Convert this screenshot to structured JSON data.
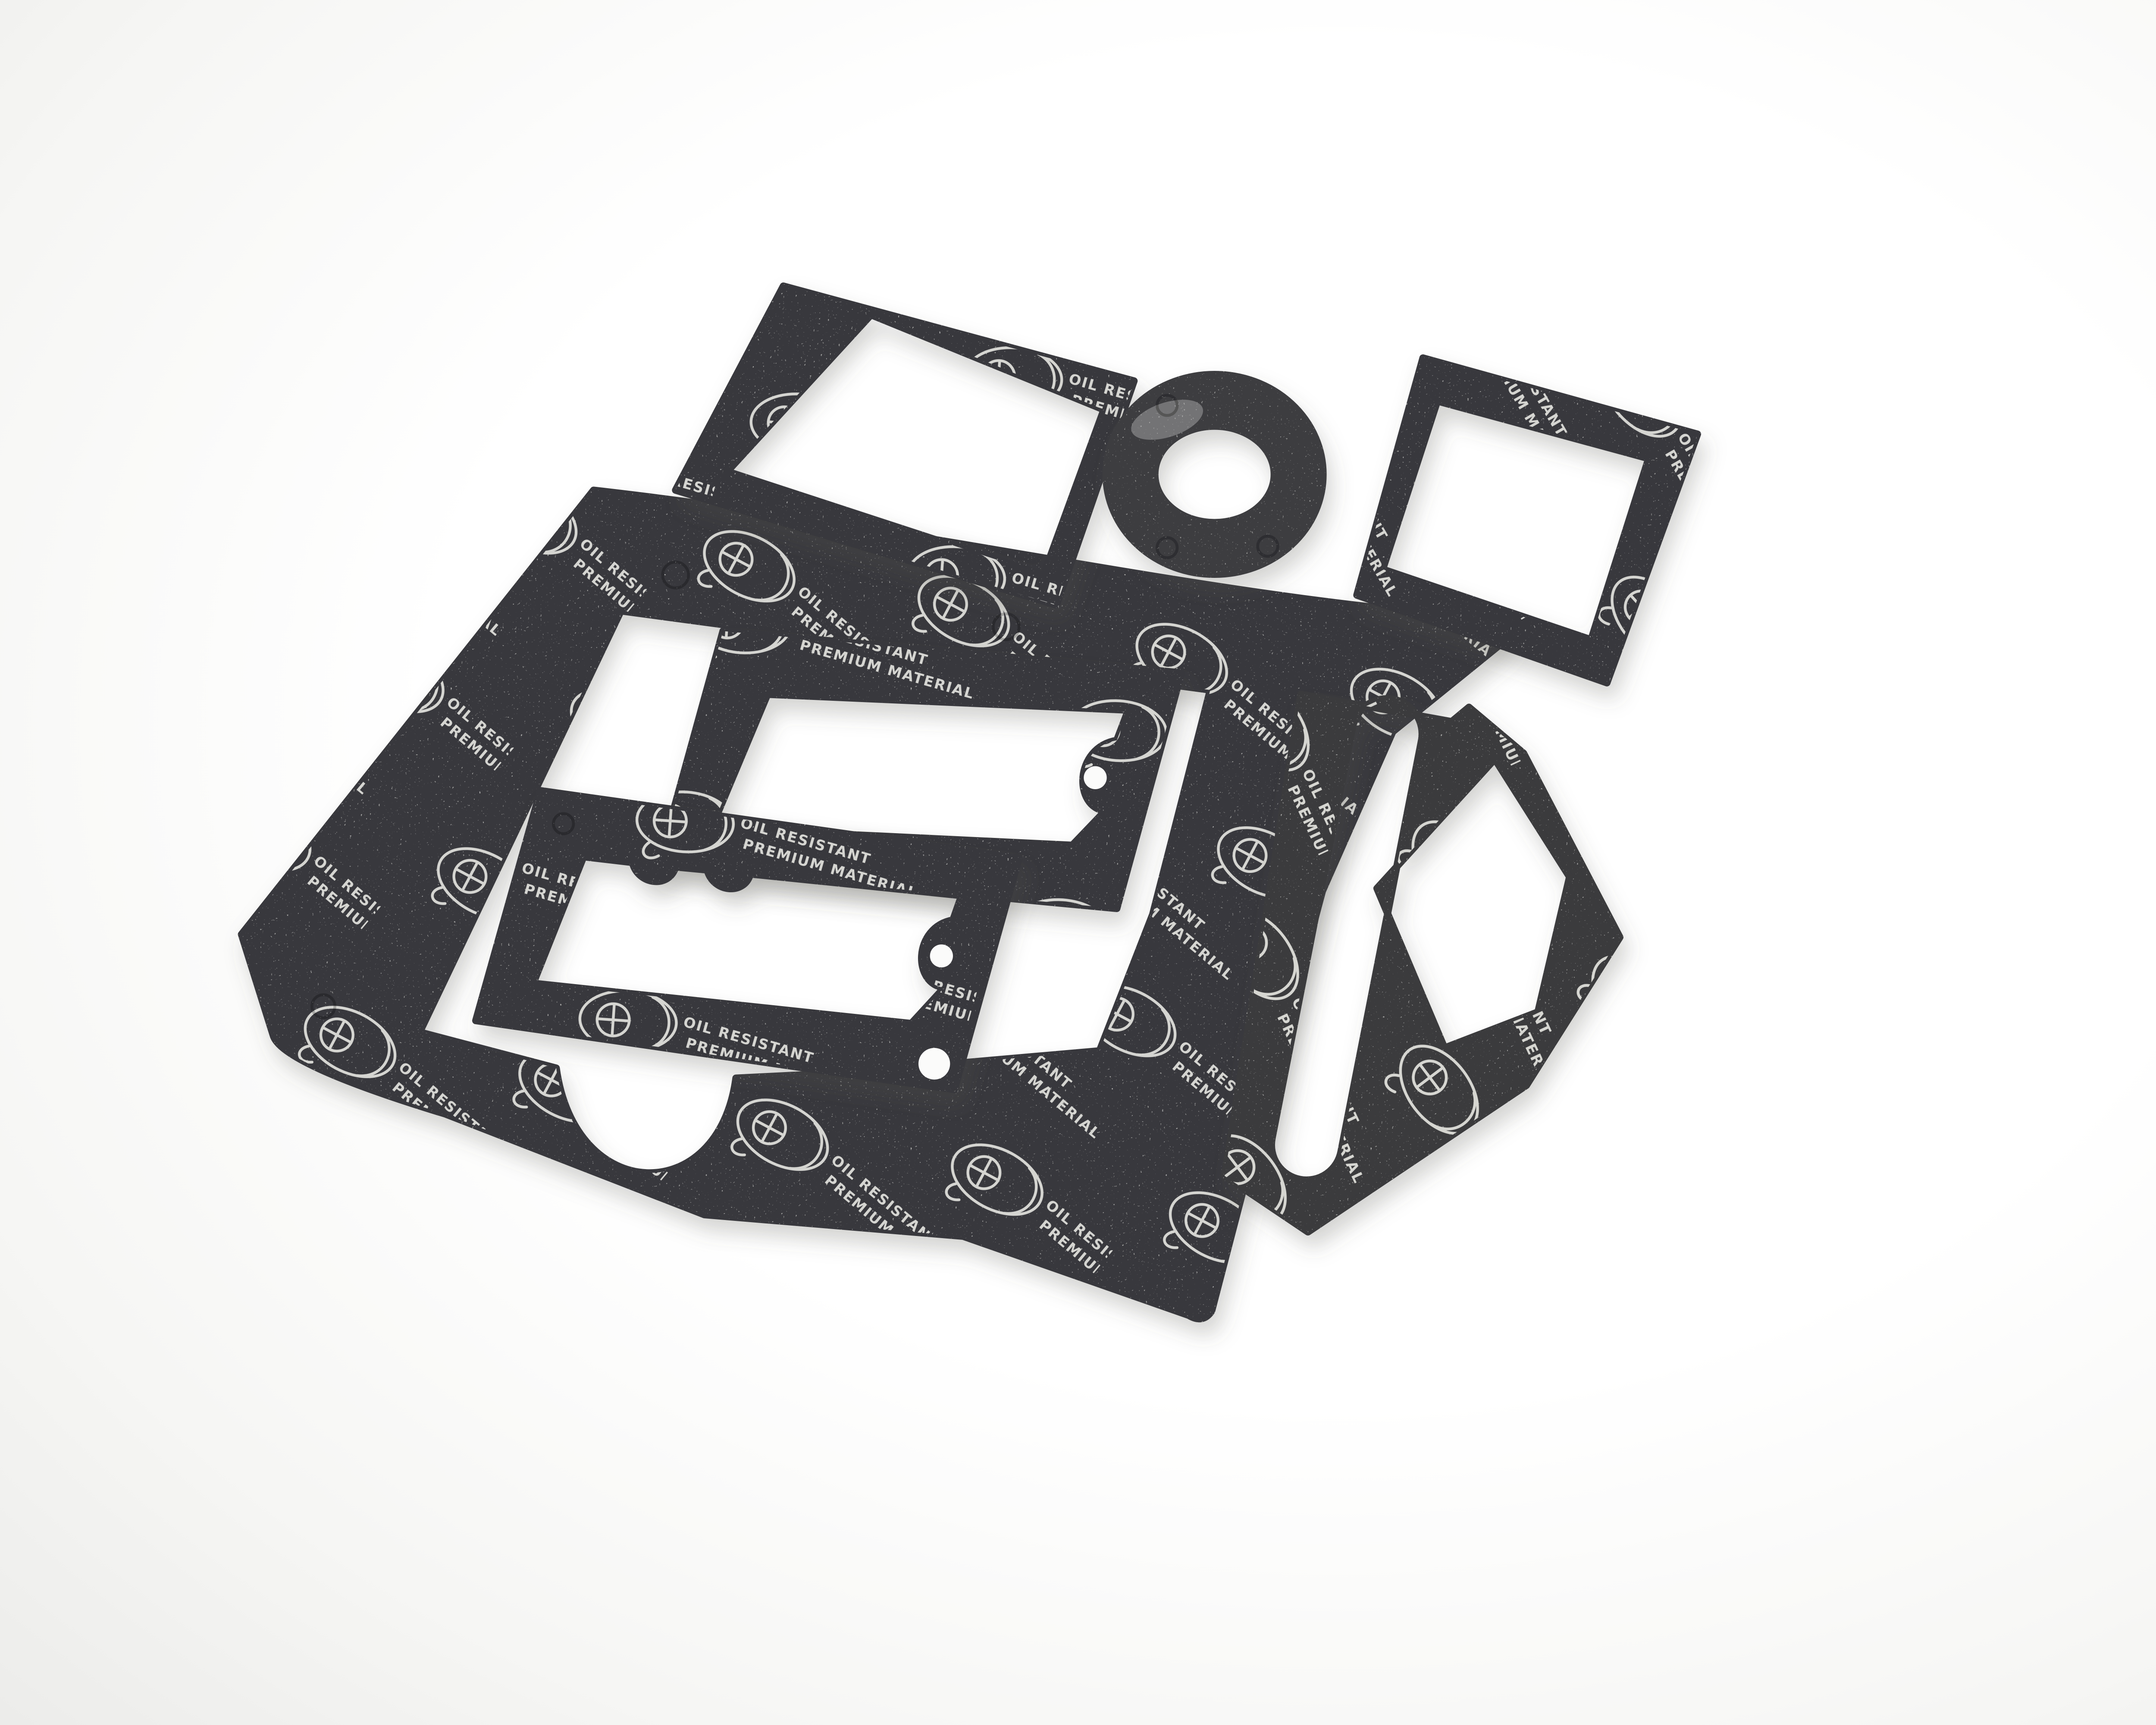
{
  "scene": {
    "type": "product-photo",
    "description": "Seven die-cut dark grey fibre gasket pieces laid out on a white seamless background, photographed at a slight angle",
    "background_color": "#f3f3f1",
    "material_color": "#39393c",
    "print_color": "#e3e3de",
    "piece_count": "7"
  },
  "print": {
    "line1": "OIL RESISTANT",
    "line2": "PREMIUM MATERIAL",
    "logo": "oval-monogram-logo"
  },
  "pieces": [
    {
      "id": "frame-gasket-top-left",
      "label": "Rectangular frame gasket, tilted, top left"
    },
    {
      "id": "washer-gasket",
      "label": "Round flat washer gasket with centre hole"
    },
    {
      "id": "frame-gasket-top-right",
      "label": "Square frame gasket, top right"
    },
    {
      "id": "sheet-gasket-large",
      "label": "Large irregular gasket sheet with big opening and semicircular notch in bottom band"
    },
    {
      "id": "frame-gasket-middle-upper",
      "label": "Scalloped rectangular frame gasket with bolt holes, upper middle"
    },
    {
      "id": "frame-gasket-middle-lower",
      "label": "Scalloped rectangular frame gasket with bolt holes, lower middle"
    },
    {
      "id": "slotted-gasket-right",
      "label": "Irregular gasket with elongated slot and hexagonal ring end, right side"
    }
  ]
}
